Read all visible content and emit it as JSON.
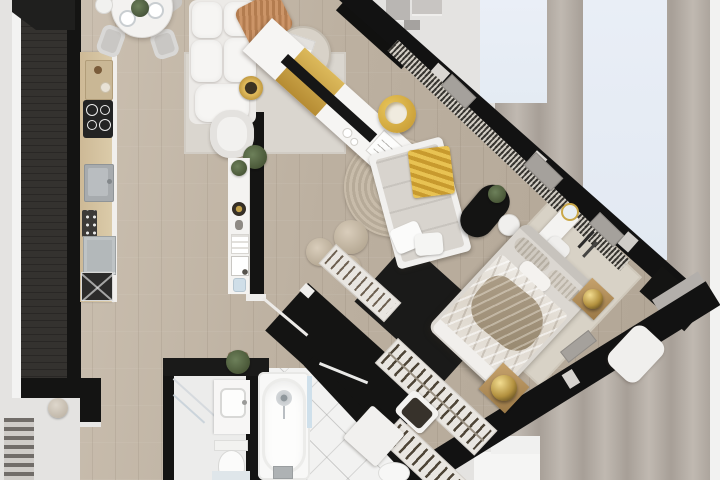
{
  "scene": {
    "title": "Top-down 3D rendered floor plan of a studio apartment with diagonal glazed facade",
    "type": "architectural-floor-plan-3d-top-view",
    "canvas": {
      "width_px": 720,
      "height_px": 480
    }
  },
  "palette": {
    "wall_black": "#141413",
    "wall_dark_gray": "#34322f",
    "wall_white_lining": "#f3f3f2",
    "wood_floor_light": "#cfc4b5",
    "wood_floor_dark": "#b0a494",
    "background_gray": "#e4e3e1",
    "facade_band_gray": "#a79f97",
    "window_glass_blue": "#e8eef6",
    "accent_gold": "#d9b556",
    "terracotta_throw": "#c48b60",
    "upholstery_white": "#f4f3f1",
    "mattress_gray": "#d6d2cc",
    "duvet_taupe": "#a2937e",
    "rug_gray": "#dad6cf",
    "jute_rug_beige": "#c2b6a4",
    "tile_white": "#f2f2f1",
    "appliance_gray": "#b3b8ba"
  },
  "rooms": [
    {
      "id": "kitchen-dining",
      "label": "Kitchen and dining corner",
      "items": [
        "kitchen counter run",
        "cutting board",
        "induction cooktop",
        "sink with faucet",
        "oven control panel",
        "dishwasher",
        "washing machine",
        "round dining table",
        "four dining chairs",
        "two set plates",
        "green centerpiece plant",
        "white teapot"
      ]
    },
    {
      "id": "living-room",
      "label": "Living room",
      "items": [
        "modular white sofa",
        "fringed terracotta throw",
        "round coffee table",
        "laptop",
        "books",
        "gold decorative bowl",
        "white armchair",
        "potted floor plant",
        "light area rug",
        "diagonal media console with gold shelf",
        "black TV panel",
        "magazines",
        "white saucers",
        "gold swivel chair"
      ]
    },
    {
      "id": "entry-hall",
      "label": "Entry hall along glazed facade",
      "items": [
        "black entry wall",
        "exterior entry steps",
        "patterned curtain runner along glazing",
        "bunched gray curtains",
        "partition display shelf with decor objects",
        "white end caps"
      ]
    },
    {
      "id": "lounge-bedroom",
      "label": "Lounge and bedroom",
      "items": [
        "round jute rug",
        "upholstered daybed",
        "gold throw blanket",
        "white pillows",
        "knitted poufs",
        "black oval side table",
        "plant",
        "white pouf",
        "double bed with rumpled taupe duvet",
        "striped roll pillows",
        "vanity desk with gold mirror",
        "vanity chair",
        "hair tools",
        "gold sphere on wooden stool",
        "second gold sphere decor",
        "bedroom area rug",
        "white bench"
      ]
    },
    {
      "id": "walk-in-closet",
      "label": "Walk-in closet",
      "items": [
        "slatted clothes rack long",
        "slatted clothes rack short",
        "hall radiator rack",
        "chair with draped clothes",
        "white laundry cabinet"
      ]
    },
    {
      "id": "bathroom-wc",
      "label": "Shower bathroom",
      "items": [
        "walk-in shower glass screen",
        "vanity with basin",
        "toilet with tank",
        "blue bath mat",
        "potted plant on partition wall"
      ]
    },
    {
      "id": "bathroom-main",
      "label": "Bathtub room",
      "items": [
        "built-in bathtub",
        "chrome drain",
        "glass splash screen",
        "tub side control",
        "toilet",
        "diagonal white floor tiles",
        "open glass door"
      ]
    },
    {
      "id": "exterior",
      "label": "Exterior surroundings",
      "items": [
        "light gray terrace",
        "glazing reflection panels",
        "vertical facade bands",
        "white steps bottom",
        "exterior staircase stripes",
        "round terrace pouf"
      ]
    }
  ]
}
